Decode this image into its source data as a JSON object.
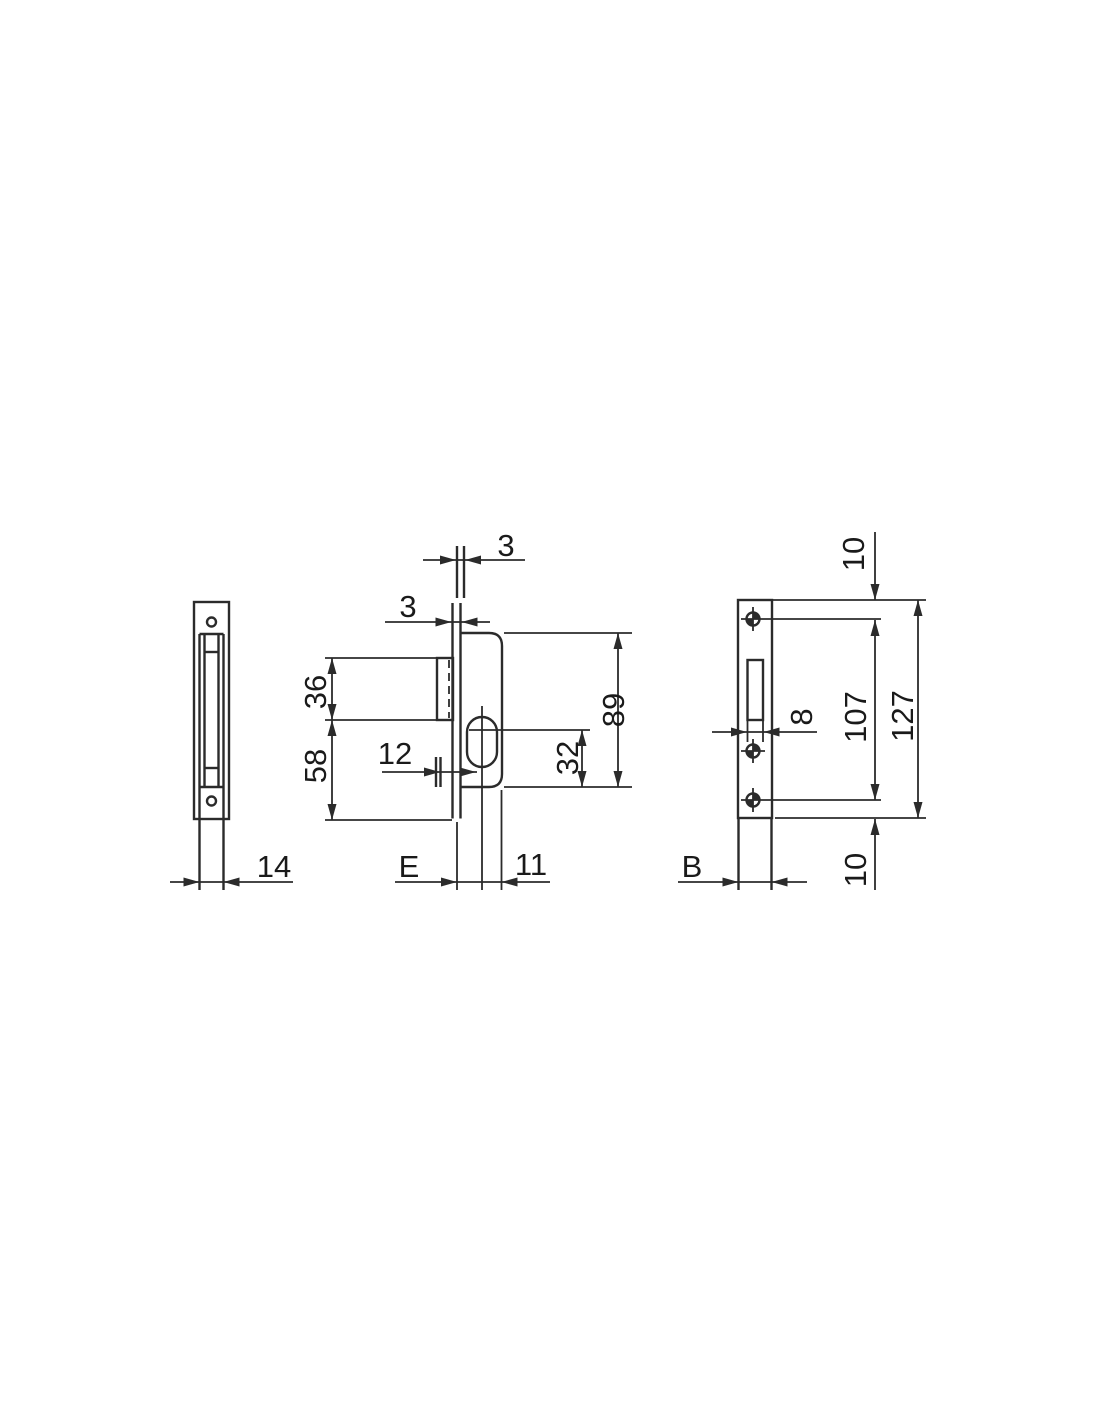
{
  "diagram": {
    "type": "technical-drawing-lock-three-views",
    "colors": {
      "line": "#2b2b2b",
      "text": "#1a1a1a",
      "background": "#ffffff"
    },
    "side_view": {
      "case_width": "14"
    },
    "front_view": {
      "strike_thickness": "3",
      "faceplate_thickness": "3",
      "pocket_height": "36",
      "pocket_to_plate_bottom": "58",
      "latch_depth": "12",
      "backset": "E",
      "center_to_case_back": "11",
      "key_center_to_case_bottom": "32",
      "case_height": "89"
    },
    "plate_view": {
      "plate_top_to_hole": "10",
      "slot_width": "8",
      "hole_spacing": "107",
      "plate_height": "127",
      "hole_to_plate_bottom": "10",
      "case_width": "B"
    }
  }
}
